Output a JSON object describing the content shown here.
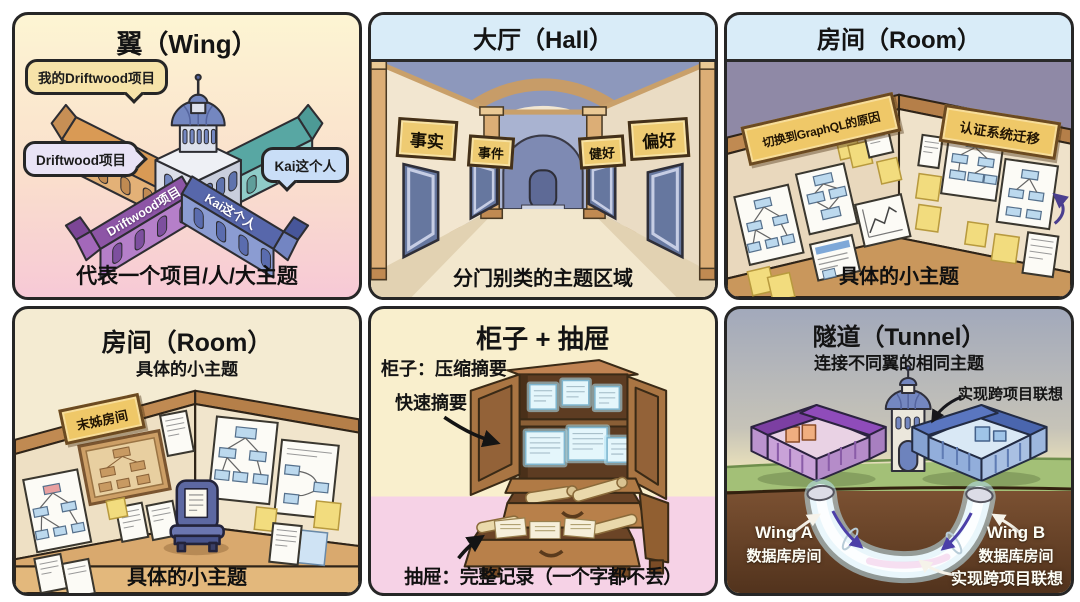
{
  "panel_wing": {
    "title": "翼（Wing）",
    "bubble_my_project": "我的Driftwood项目",
    "bubble_project": "Driftwood项目",
    "bubble_kai": "Kai这个人",
    "roof_purple": "Driftwood项目",
    "roof_blue": "Kai这个人",
    "caption": "代表一个项目/人/大主题"
  },
  "panel_hall": {
    "title": "大厅（Hall）",
    "signs": [
      "事实",
      "事件",
      "健好",
      "偏好"
    ],
    "caption": "分门别类的主题区域"
  },
  "panel_room_a": {
    "title": "房间（Room）",
    "plaque_left": "切换到GraphQL的原因",
    "plaque_right": "认证系统迁移",
    "caption": "具体的小主题"
  },
  "panel_room_b": {
    "title": "房间（Room）",
    "subtitle": "具体的小主题",
    "plaque": "末姊房间",
    "caption": "具体的小主题"
  },
  "panel_cabinet": {
    "title": "柜子 + 抽屉",
    "label_cabinet": "柜子：压缩摘要",
    "label_quick": "快速摘要",
    "caption": "抽屉：完整记录（一个字都不丢）"
  },
  "panel_tunnel": {
    "title": "隧道（Tunnel）",
    "subtitle": "连接不同翼的相同主题",
    "label_top": "实现跨项目联想",
    "label_bottom": "实现跨项目联想",
    "wing_a_line1": "Wing A",
    "wing_a_line2": "数据库房间",
    "wing_b_line1": "Wing B",
    "wing_b_line2": "数据库房间"
  },
  "colors": {
    "header_band": "#d9ecf8",
    "sign_yellow": "#eecb72",
    "plaque_wood": "#efc868",
    "tunnel_glow": "#bfe9f8",
    "wing_purple": "#8d55a6",
    "wing_blue": "#5767ab",
    "wing_orange": "#d99a55",
    "wing_teal": "#58a7a3"
  }
}
